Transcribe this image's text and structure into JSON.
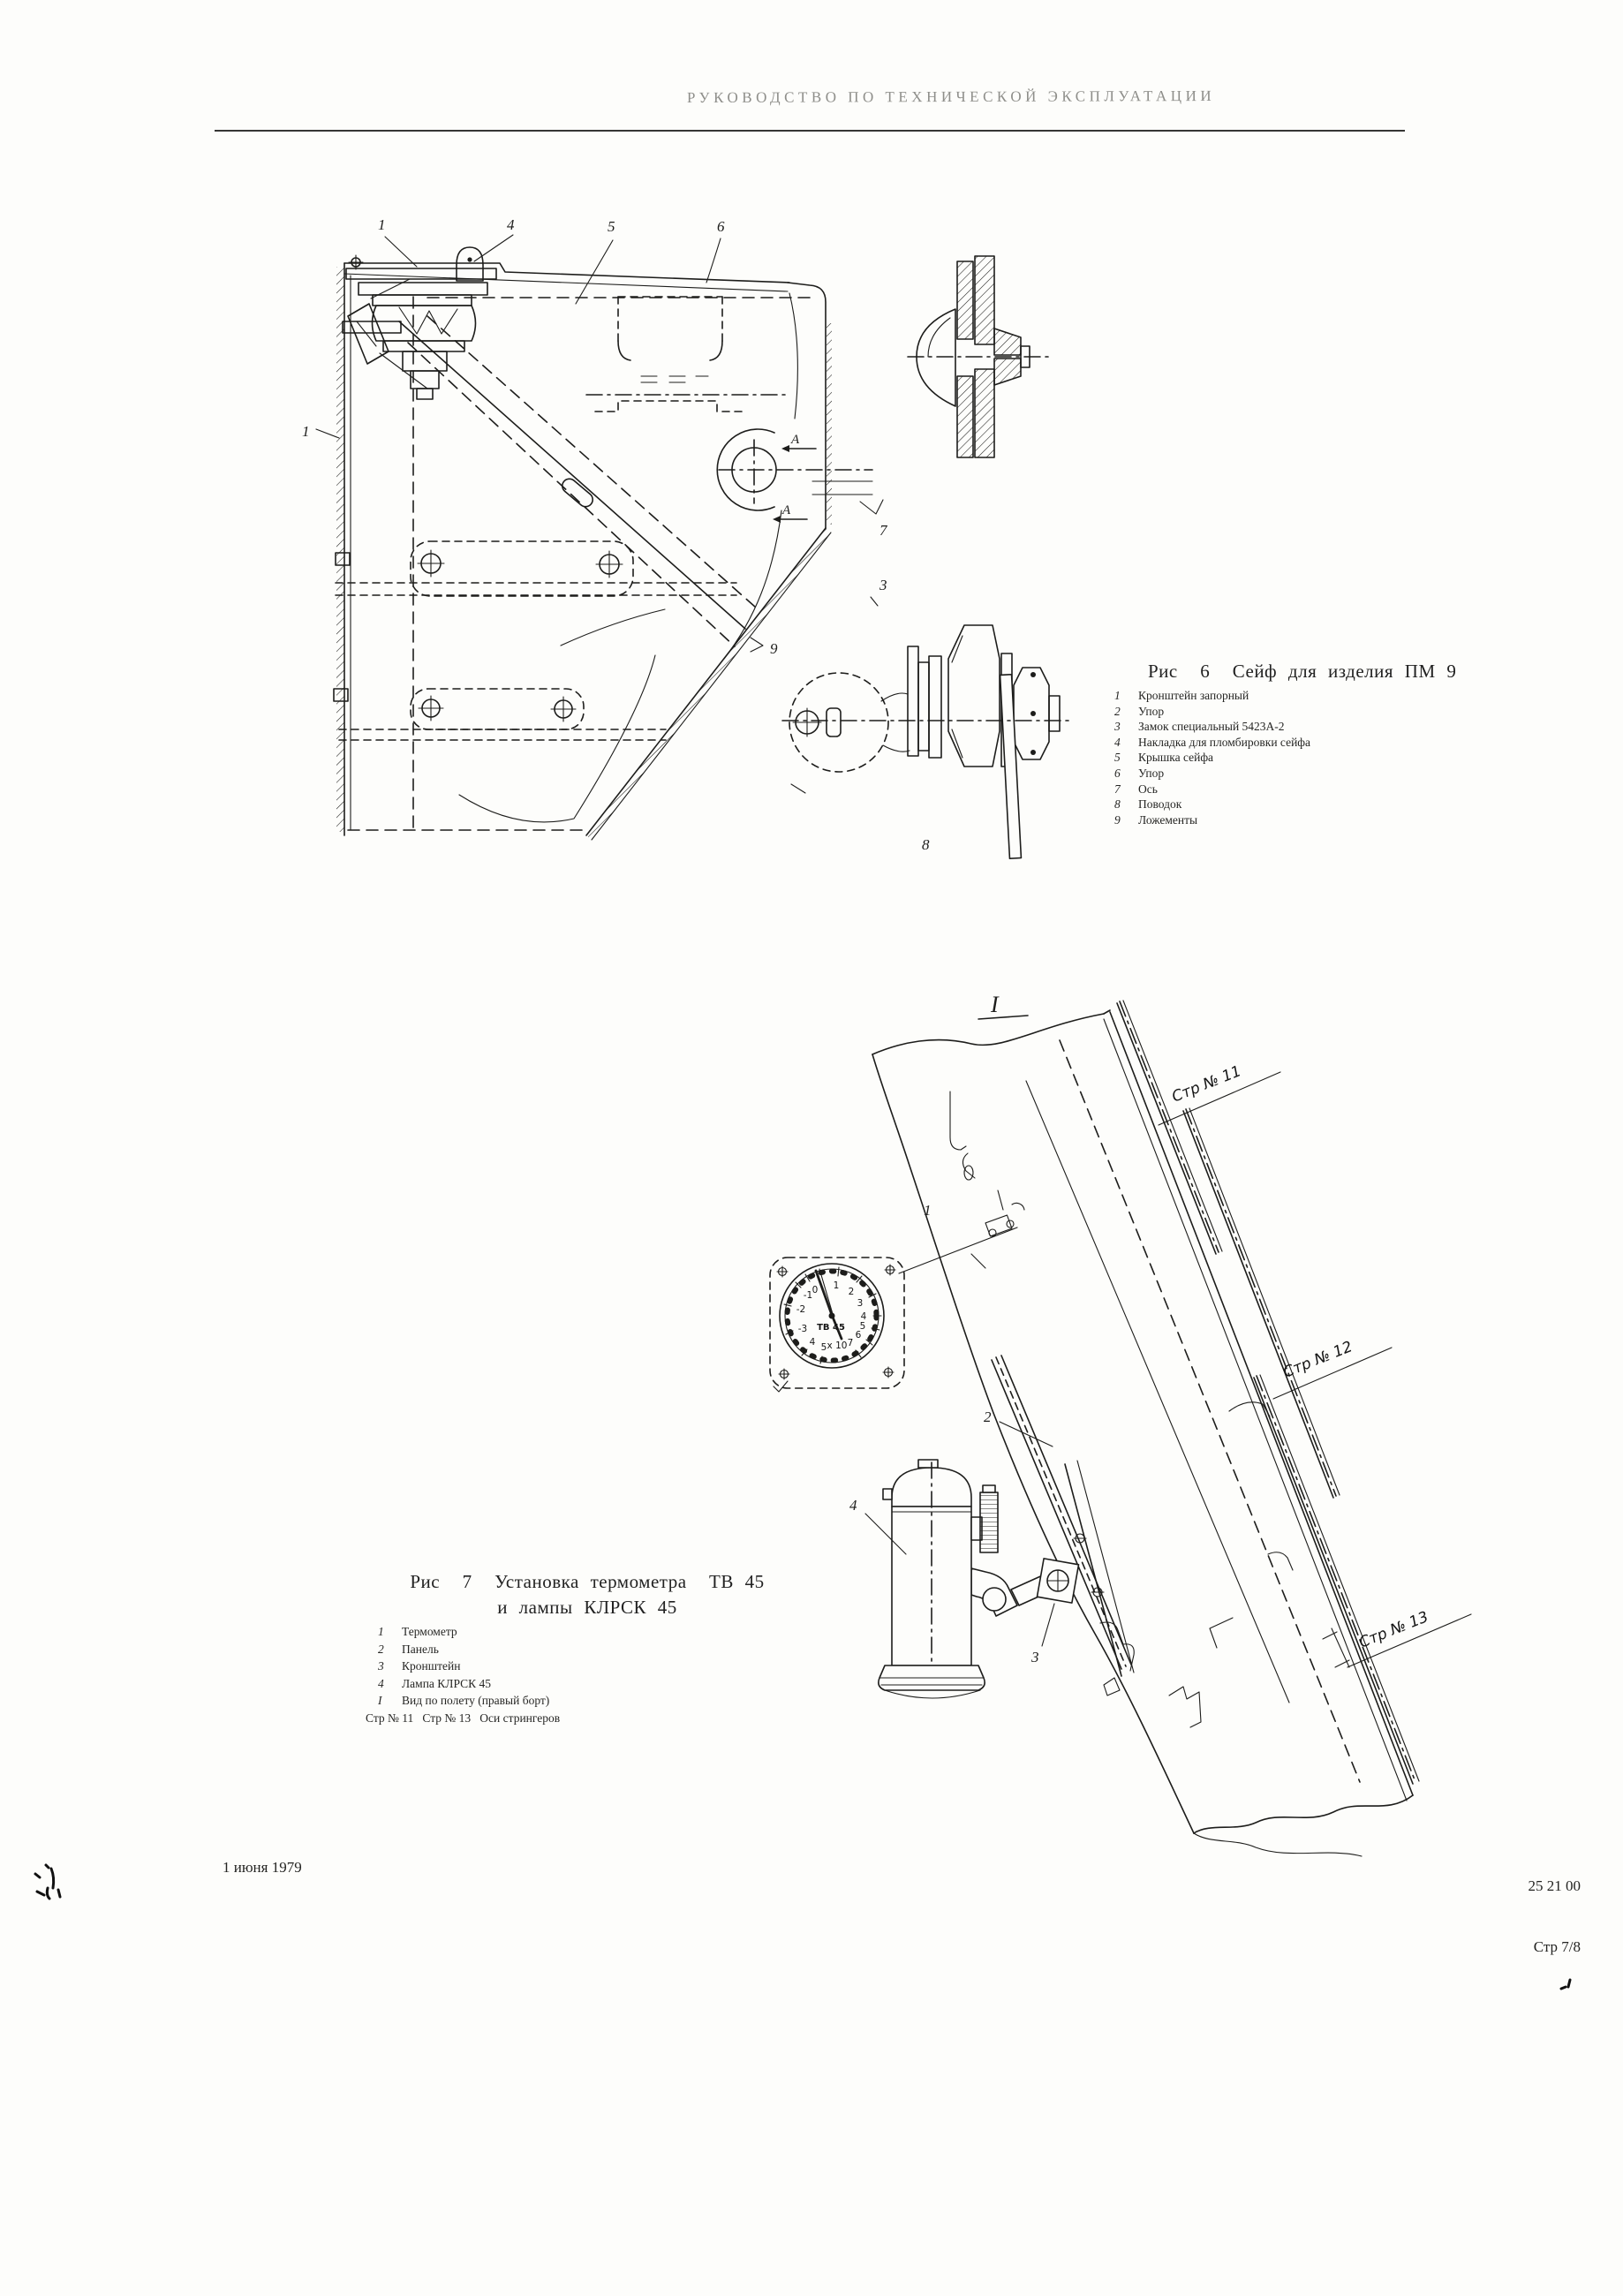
{
  "page": {
    "header": "РУКОВОДСТВО ПО ТЕХНИЧЕСКОЙ ЭКСПЛУАТАЦИИ",
    "footer": {
      "date": "1 июня 1979",
      "doc_number": "25 21 00",
      "page_number": "Стр 7/8"
    }
  },
  "fig6": {
    "title": "Рис  6  Сейф для изделия ПМ 9",
    "parts": [
      {
        "num": "1",
        "name": "Кронштейн запорный"
      },
      {
        "num": "2",
        "name": "Упор"
      },
      {
        "num": "3",
        "name": "Замок специальный 5423А-2"
      },
      {
        "num": "4",
        "name": "Накладка для пломбировки сейфа"
      },
      {
        "num": "5",
        "name": "Крышка сейфа"
      },
      {
        "num": "6",
        "name": "Упор"
      },
      {
        "num": "7",
        "name": "Ось"
      },
      {
        "num": "8",
        "name": "Поводок"
      },
      {
        "num": "9",
        "name": "Ложементы"
      }
    ],
    "callouts": {
      "c1": "1",
      "c4": "4",
      "c5": "5",
      "c6": "6",
      "c1b": "1",
      "c7": "7",
      "c3": "3",
      "c9": "9",
      "c8": "8"
    },
    "section_letter": "А"
  },
  "fig7": {
    "detail_label": "I",
    "title_line1": "Рис  7  Установка термометра  ТВ 45",
    "title_line2": "и лампы КЛРСК 45",
    "parts": [
      {
        "num": "1",
        "name": "Термометр"
      },
      {
        "num": "2",
        "name": "Панель"
      },
      {
        "num": "3",
        "name": "Кронштейн"
      },
      {
        "num": "4",
        "name": "Лампа КЛРСК 45"
      }
    ],
    "notes": [
      {
        "num": "I",
        "name": "Вид по полету (правый борт)"
      },
      {
        "num": "",
        "name": "Стр № 11   Стр № 13   Оси стрингеров"
      }
    ],
    "stringers": [
      "Стр № 11",
      "Стр № 12",
      "Стр № 13"
    ],
    "callouts": {
      "c1": "1",
      "c2": "2",
      "c3": "3",
      "c4": "4"
    },
    "gauge": {
      "label": "ТВ 45",
      "multiplier": "x 10",
      "dial": [
        "0",
        "1",
        "2",
        "3",
        "4",
        "5",
        "6",
        "7",
        "-1",
        "-2",
        "-3",
        "4",
        "5"
      ]
    }
  }
}
